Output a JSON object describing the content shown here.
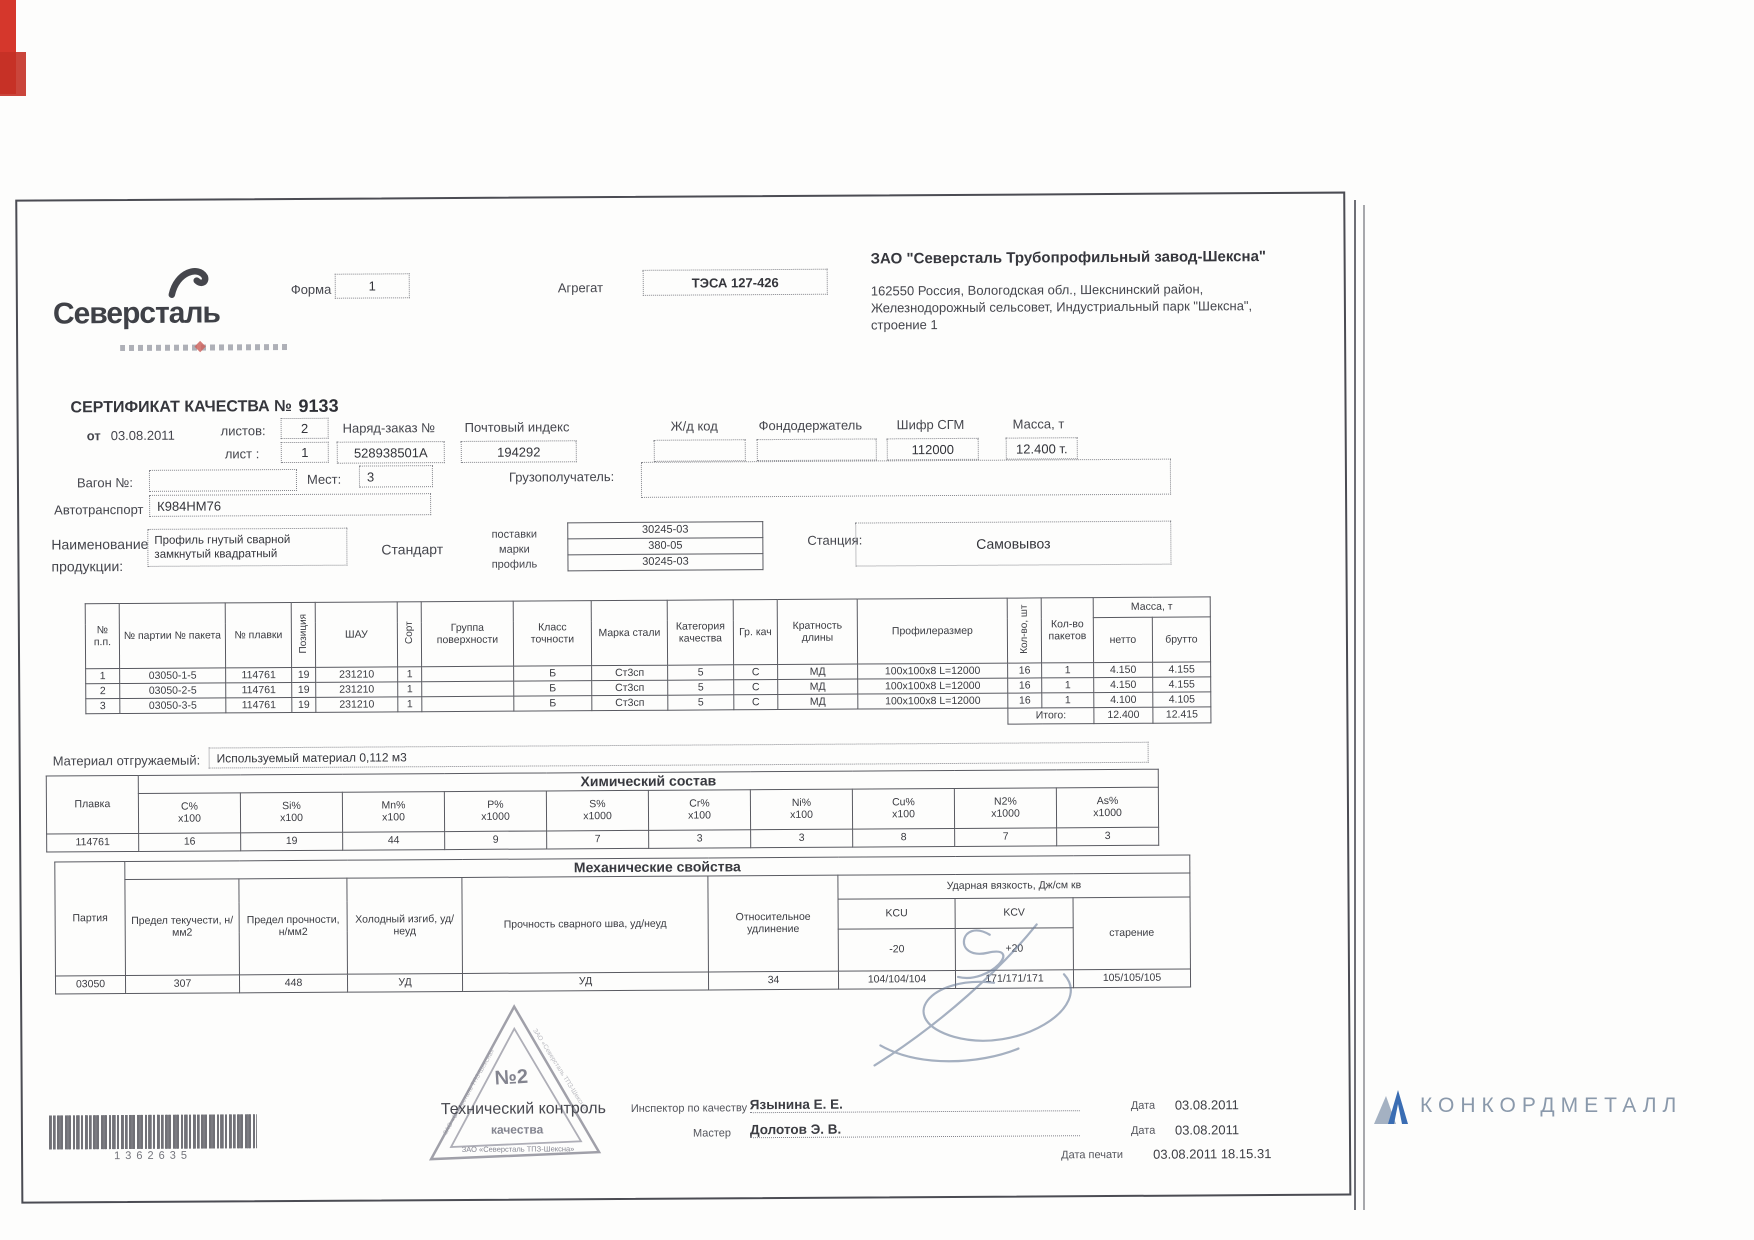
{
  "header": {
    "logo_text": "Северсталь",
    "form_label": "Форма",
    "form_value": "1",
    "aggregate_label": "Агрегат",
    "aggregate_value": "ТЭСА 127-426",
    "company_name": "ЗАО \"Северсталь Трубопрофильный завод-Шексна\"",
    "address_line1": "162550 Россия, Вологодская обл., Шекснинский район,",
    "address_line2": "Железнодорожный сельсовет, Индустриальный парк \"Шексна\",",
    "address_line3": "строение 1"
  },
  "certificate": {
    "title": "СЕРТИФИКАТ КАЧЕСТВА №",
    "number": "9133",
    "date_label": "от",
    "date_value": "03.08.2011",
    "sheets_label": "листов:",
    "sheets_value": "2",
    "sheet_label": "лист :",
    "sheet_value": "1",
    "order_label": "Наряд-заказ №",
    "order_value": "528938501А",
    "postcode_label": "Почтовый индекс",
    "postcode_value": "194292",
    "railcode_label": "Ж/д код",
    "railcode_value": "",
    "fundholder_label": "Фондодержатель",
    "fundholder_value": "",
    "sgm_label": "Шифр СГМ",
    "sgm_value": "112000",
    "mass_label": "Масса, т",
    "mass_value": "12.400 т.",
    "wagon_label": "Вагон №:",
    "wagon_value": "",
    "places_label": "Мест:",
    "places_value": "3",
    "consignee_label": "Грузополучатель:",
    "consignee_value": "",
    "truck_label": "Автотранспорт",
    "truck_value": "К984НМ76",
    "product_label_line1": "Наименование",
    "product_label_line2": "продукции:",
    "product_value_line1": "Профиль гнутый сварной",
    "product_value_line2": "замкнутый квадратный",
    "standard_label": "Стандарт",
    "standard_row_labels": [
      "поставки",
      "марки",
      "профиль"
    ],
    "standard_values": [
      "30245-03",
      "380-05",
      "30245-03"
    ],
    "station_label": "Станция:",
    "station_value": "Самовывоз"
  },
  "main_table": {
    "headers": {
      "num": "№ п.п.",
      "batch": "№ партии № пакета",
      "melt": "№ плавки",
      "position": "Позиция",
      "shau": "ШАУ",
      "sort": "Сорт",
      "surface_group": "Группа поверхности",
      "accuracy_class": "Класс точности",
      "steel_grade": "Марка стали",
      "quality_category": "Категория качества",
      "quality_group": "Гр. кач",
      "length_multiplicity": "Кратность длины",
      "profile_size": "Профилеразмер",
      "qty_pcs": "Кол-во, шт",
      "qty_packs": "Кол-во пакетов",
      "mass": "Масса, т",
      "net": "нетто",
      "gross": "брутто"
    },
    "rows": [
      [
        "1",
        "03050-1-5",
        "114761",
        "19",
        "231210",
        "1",
        "",
        "Б",
        "Ст3сп",
        "5",
        "С",
        "МД",
        "100х100х8 L=12000",
        "16",
        "1",
        "4.150",
        "4.155"
      ],
      [
        "2",
        "03050-2-5",
        "114761",
        "19",
        "231210",
        "1",
        "",
        "Б",
        "Ст3сп",
        "5",
        "С",
        "МД",
        "100х100х8 L=12000",
        "16",
        "1",
        "4.150",
        "4.155"
      ],
      [
        "3",
        "03050-3-5",
        "114761",
        "19",
        "231210",
        "1",
        "",
        "Б",
        "Ст3сп",
        "5",
        "С",
        "МД",
        "100х100х8 L=12000",
        "16",
        "1",
        "4.100",
        "4.105"
      ]
    ],
    "total_label": "Итого:",
    "total_net": "12.400",
    "total_gross": "12.415"
  },
  "material": {
    "label": "Материал отгружаемый:",
    "value": "Используемый материал 0,112 м3"
  },
  "chemistry": {
    "title": "Химический состав",
    "melt_header": "Плавка",
    "melt_value": "114761",
    "columns": [
      {
        "name": "C%",
        "scale": "х100"
      },
      {
        "name": "Si%",
        "scale": "х100"
      },
      {
        "name": "Mn%",
        "scale": "х100"
      },
      {
        "name": "P%",
        "scale": "х1000"
      },
      {
        "name": "S%",
        "scale": "х1000"
      },
      {
        "name": "Cr%",
        "scale": "х100"
      },
      {
        "name": "Ni%",
        "scale": "х100"
      },
      {
        "name": "Cu%",
        "scale": "х100"
      },
      {
        "name": "N2%",
        "scale": "х1000"
      },
      {
        "name": "As%",
        "scale": "х1000"
      }
    ],
    "values": [
      "16",
      "19",
      "44",
      "9",
      "7",
      "3",
      "3",
      "8",
      "7",
      "3"
    ]
  },
  "mechanics": {
    "title": "Механические свойства",
    "party_header": "Партия",
    "party_value": "03050",
    "col_yield": "Предел текучести, н/мм2",
    "col_strength": "Предел прочности, н/мм2",
    "col_cold_bend": "Холодный изгиб, уд/неуд",
    "col_weld": "Прочность сварного шва, уд/неуд",
    "col_elongation": "Относительное удлинение",
    "col_impact": "Ударная вязкость, Дж/см кв",
    "col_kcu": "KCU",
    "col_kcv": "KCV",
    "col_aging": "старение",
    "kcu_temp": "-20",
    "kcv_temp": "+20",
    "values": {
      "yield": "307",
      "strength": "448",
      "cold_bend": "УД",
      "weld": "УД",
      "elongation": "34",
      "kcu": "104/104/104",
      "kcv": "171/171/171",
      "aging": "105/105/105"
    }
  },
  "stamp": {
    "number": "№2",
    "caption_line1": "Технический контроль",
    "caption_line2": "качества",
    "ring_text": "ЗАО «Северсталь ТПЗ-Шексна»"
  },
  "signoff": {
    "inspector_label": "Инспектор по качеству",
    "inspector_name": "Язынина Е. Е.",
    "master_label": "Мастер",
    "master_name": "Долотов Э. В.",
    "date_label1": "Дата",
    "date_value1": "03.08.2011",
    "date_label2": "Дата",
    "date_value2": "03.08.2011",
    "print_date_label": "Дата печати",
    "print_date_value": "03.08.2011 18.15.31"
  },
  "barcode": {
    "number": "1362635"
  },
  "footer_brand": {
    "name": "КОНКОРДМЕТАЛЛ"
  },
  "colors": {
    "accent_red": "#d5372c",
    "stamp_gray": "#8b8b96",
    "brand_blue": "#3a6db3",
    "brand_gray": "#8a99ab"
  }
}
